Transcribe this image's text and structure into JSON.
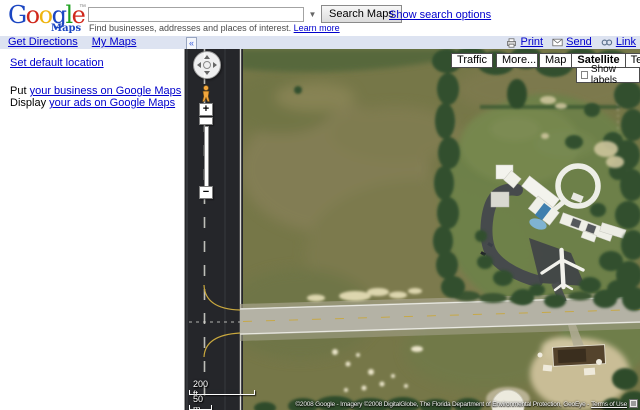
{
  "colors": {
    "link": "#0000cc",
    "toolbar-bg": "#dde3f1",
    "logo-blue": "#1b46c2",
    "logo-red": "#d0281c",
    "logo-yellow": "#efb511",
    "logo-green": "#1ea11f",
    "grass": "#767748",
    "runway-asphalt": "#25262a",
    "taxiway": "#b4b2a5",
    "trees": "#31502d"
  },
  "header": {
    "logo": {
      "g1": "G",
      "o1": "o",
      "o2": "o",
      "g2": "g",
      "l1": "l",
      "e1": "e",
      "tm": "™",
      "sub": "Maps"
    },
    "search": {
      "value": "",
      "dropdown_arrow": "▼",
      "submit": "Search Maps",
      "options": "Show search options",
      "hint": "Find businesses, addresses and places of interest.",
      "learn_more": "Learn more"
    }
  },
  "toolbar": {
    "get_directions": "Get Directions",
    "my_maps": "My Maps",
    "print": "Print",
    "send": "Send",
    "link": "Link",
    "collapse": "«"
  },
  "sidebar": {
    "set_default_location": "Set default location",
    "business_prefix": "Put",
    "business_link": "your business on Google Maps",
    "ads_prefix": "Display",
    "ads_link": "your ads on Google Maps"
  },
  "map": {
    "buttons": {
      "traffic": "Traffic",
      "more": "More...",
      "map": "Map",
      "satellite": "Satellite",
      "terrain": "Terrain"
    },
    "show_labels_label": "Show labels",
    "show_labels_checked": false,
    "zoom_plus": "+",
    "zoom_minus": "−",
    "scale_ft": "200 ft",
    "scale_m": "50 m",
    "copyright": "©2008 Google - Imagery ©2008 DigitalGlobe, The Florida Department of Environmental Protection, GeoEye -",
    "terms": "Terms of Use"
  }
}
